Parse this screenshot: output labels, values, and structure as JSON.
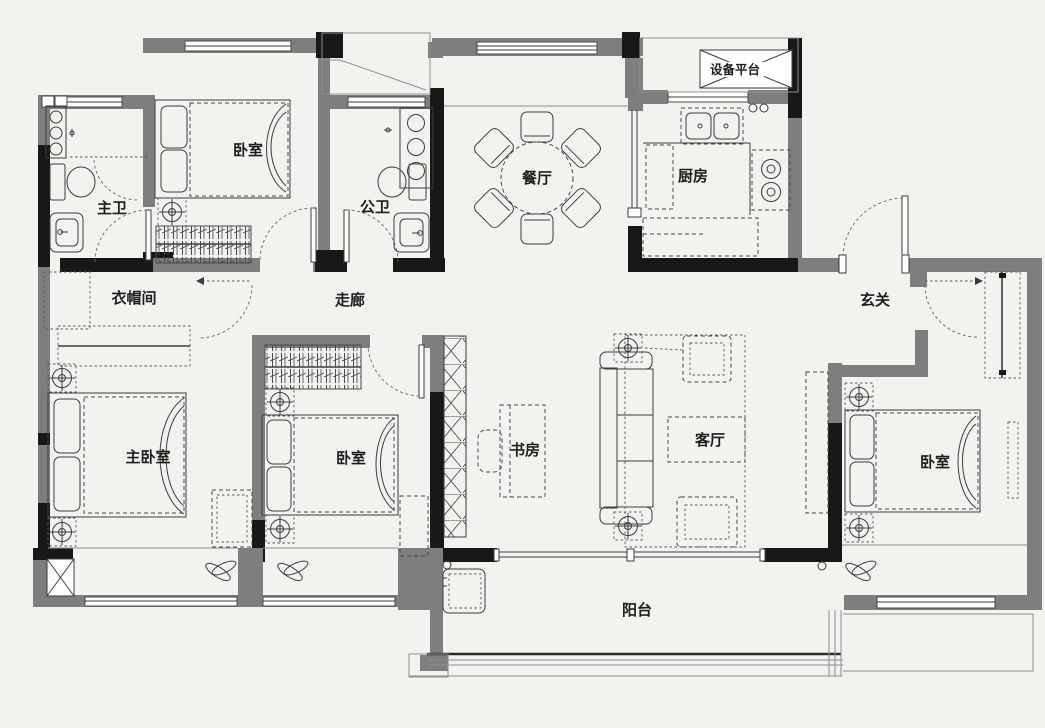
{
  "plan": {
    "type": "residential-floor-plan",
    "colors": {
      "wall": "#7e7e7e",
      "column": "#181818",
      "background": "#f4f2ee",
      "line": "#3c3c3c"
    },
    "rooms": [
      {
        "id": "master-bath",
        "label": "主卫"
      },
      {
        "id": "bedroom-north",
        "label": "卧室"
      },
      {
        "id": "guest-bath",
        "label": "公卫"
      },
      {
        "id": "dining-room",
        "label": "餐厅"
      },
      {
        "id": "kitchen",
        "label": "厨房"
      },
      {
        "id": "equipment-platform",
        "label": "设备平台"
      },
      {
        "id": "cloakroom",
        "label": "衣帽间"
      },
      {
        "id": "corridor",
        "label": "走廊"
      },
      {
        "id": "foyer",
        "label": "玄关"
      },
      {
        "id": "master-bedroom",
        "label": "主卧室"
      },
      {
        "id": "bedroom-middle",
        "label": "卧室"
      },
      {
        "id": "study",
        "label": "书房"
      },
      {
        "id": "living-room",
        "label": "客厅"
      },
      {
        "id": "bedroom-east",
        "label": "卧室"
      },
      {
        "id": "balcony",
        "label": "阳台"
      }
    ]
  }
}
